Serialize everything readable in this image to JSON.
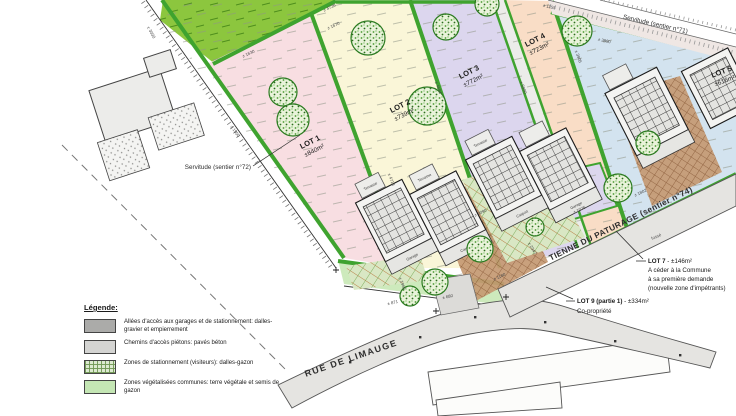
{
  "colors": {
    "hedge_green": "#3fa32f",
    "field_green": "#8cc63e",
    "road_gray": "#e5e4e1",
    "brown_hatch": "#c59a73",
    "lot1": "#f8dee2",
    "lot2": "#faf6d8",
    "lot3": "#dcd6ee",
    "lot4": "#f9ddc6",
    "lot5_zone": "#d3e3ef"
  },
  "lots": [
    {
      "name": "LOT 1",
      "area": "±840m²",
      "color": "#f8dee2"
    },
    {
      "name": "LOT 2",
      "area": "±739m²",
      "color": "#faf6d8"
    },
    {
      "name": "LOT 3",
      "area": "±772m²",
      "color": "#dcd6ee"
    },
    {
      "name": "LOT 4",
      "area": "±723m²",
      "color": "#f9ddc6"
    },
    {
      "name": "LOT 5",
      "area": "±616m²",
      "color": "#d3e3ef"
    }
  ],
  "parcel_1076_color": "#dcd6ee",
  "streets": {
    "rue": "RUE DE LIMAUGE",
    "tienne": "TIENNE DU PATURAGE (sentier n°74)",
    "serv71": "Servitude (sentier n°71)",
    "serv72": "Servitude (sentier n°72)"
  },
  "annotations": {
    "lot7": {
      "title": "LOT 7",
      "suffix": " - ±146m²",
      "line1": "A céder à la Commune",
      "line2": "à sa première demande",
      "line3": "(nouvelle zone d'impétrants)"
    },
    "lot9": {
      "title": "LOT 9 (partie 1)",
      "suffix": " - ±334m²",
      "line1": "Co-propriété"
    }
  },
  "legend": {
    "title": "Légende:",
    "items": [
      {
        "label": "Allées d'accès aux garages et de stationnement: dalles-gravier et empierrement",
        "swatch": "dark-gray"
      },
      {
        "label": "Chemins d'accès piétons: pavés béton",
        "swatch": "light-gray"
      },
      {
        "label": "Zones de stationnement (visiteurs): dalles-gazon",
        "swatch": "green-hatch"
      },
      {
        "label": "Zones végétalisées communes: terre végétale et semis de gazon",
        "swatch": "light-green"
      }
    ]
  },
  "rooms": {
    "terrasse": "Terrasse",
    "garage": "Garage",
    "carport": "Carport"
  },
  "labels": {
    "fosse": "fossé"
  },
  "dims": [
    "± 4720",
    "± 1670",
    "± 1630",
    "± 1155",
    "± 3890",
    "± 3905",
    "± 4718",
    "± 4594",
    "± 5990",
    "± 1950",
    "± 3030",
    "± 1076",
    "± 871",
    "± 680",
    "± 1180",
    "± 1966",
    "± 2347",
    "± 2090",
    "± 1802"
  ]
}
